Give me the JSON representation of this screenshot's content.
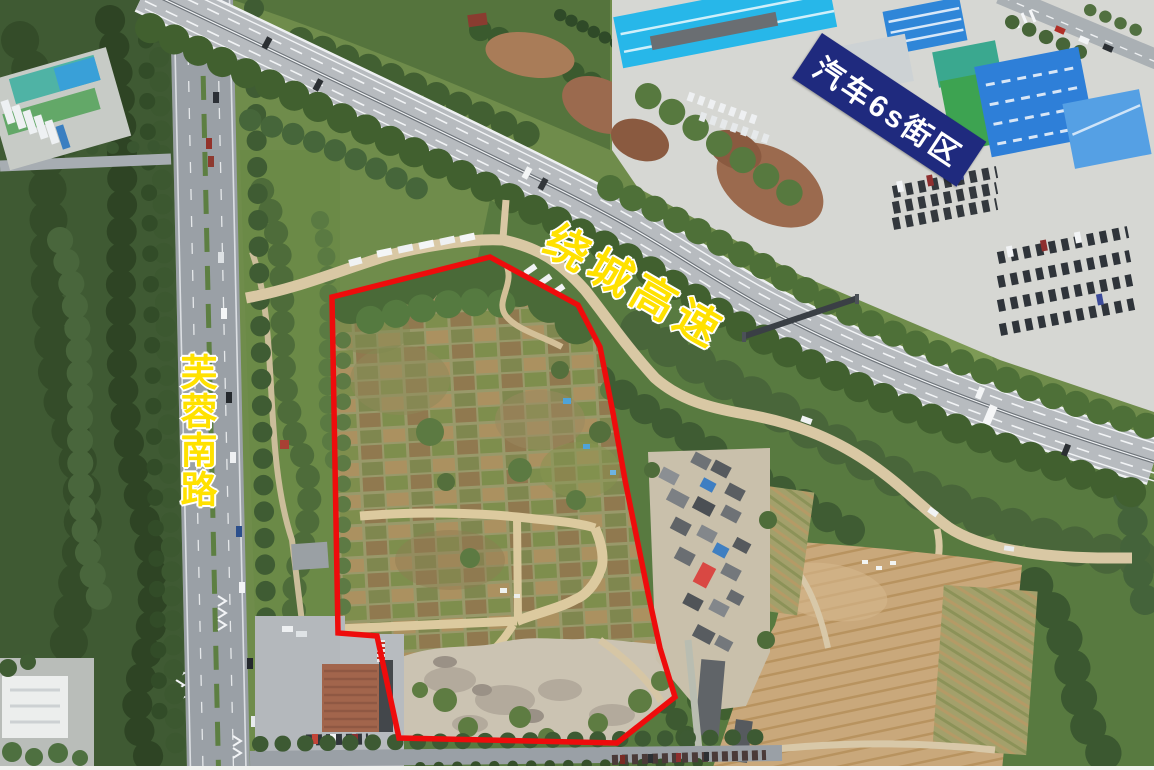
{
  "annotations": {
    "district_label": "汽车6s街区",
    "highway_label": "绕城高速",
    "road_label": "芙蓉南路"
  },
  "colors": {
    "boundary_red": "#ee0c0c",
    "label_yellow": "#ffe100",
    "district_bg": "#1f2a7e",
    "district_text": "#ffffff"
  }
}
